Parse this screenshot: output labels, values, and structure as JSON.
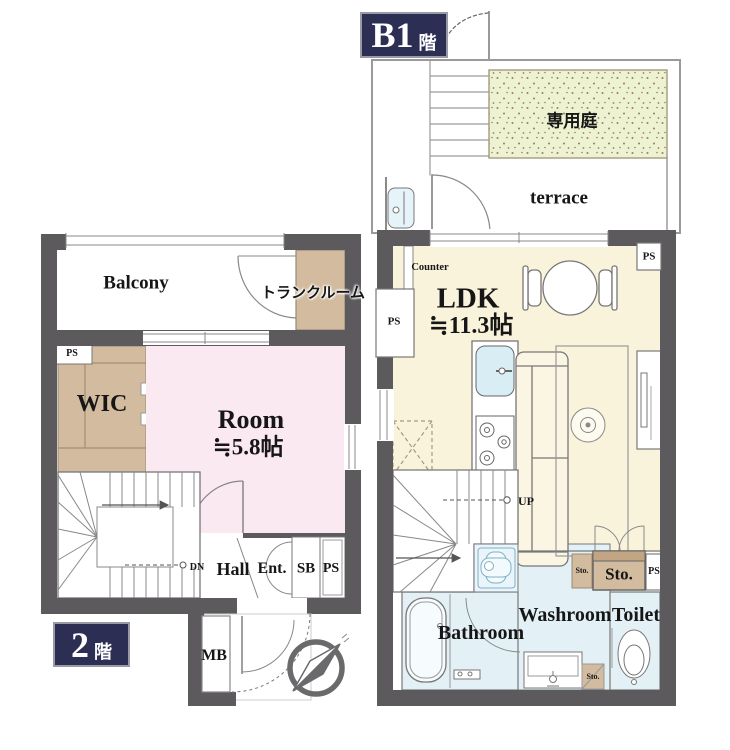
{
  "colors": {
    "wall": "#5c5a5d",
    "badge_navy": "#2c2e54",
    "ldk_floor": "#faf3dc",
    "room_floor": "#fbe9f2",
    "storage_tan": "#d2bb9e",
    "wet_area_blue": "#e3f1f7",
    "garden_green": "#edf3d2"
  },
  "b1_floor": {
    "badge": {
      "number": "B1",
      "floor_suffix": "階"
    },
    "garden_label": "専用庭",
    "terrace_label": "terrace",
    "counter_label": "Counter",
    "ldk": {
      "name": "LDK",
      "area": "≒11.3帖"
    },
    "ps_left": "PS",
    "ps_top_right": "PS",
    "ps_lower": "PS",
    "up_label": "UP",
    "washroom_label": "Washroom",
    "toilet_label": "Toilet",
    "bathroom_label": "Bathroom",
    "sto_small": "Sto.",
    "sto_large": "Sto.",
    "sto_bottom": "Sto."
  },
  "f2_floor": {
    "badge": {
      "number": "2",
      "floor_suffix": "階"
    },
    "balcony_label": "Balcony",
    "trunk_room_label": "トランクルーム",
    "wic_label": "WIC",
    "room": {
      "name": "Room",
      "area": "≒5.8帖"
    },
    "ps_top": "PS",
    "ps_entrance": "PS",
    "dn_label": "DN",
    "hall_label": "Hall",
    "ent_label": "Ent.",
    "sb_label": "SB",
    "mb_label": "MB"
  }
}
